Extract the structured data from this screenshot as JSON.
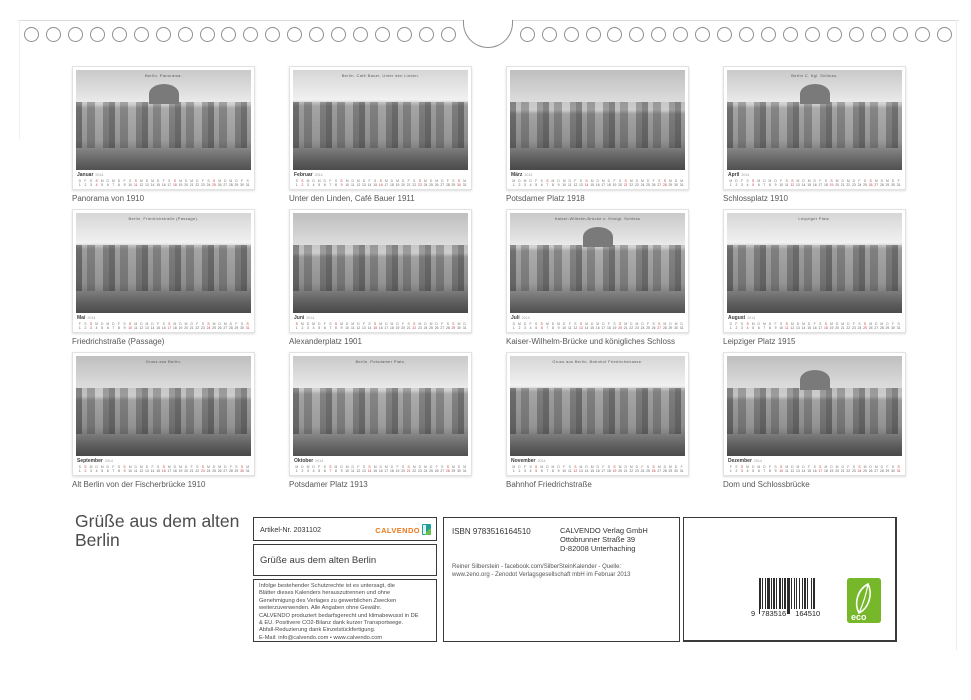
{
  "title": {
    "lines": "Grüße aus dem alten\nBerlin"
  },
  "months": [
    {
      "month": "Januar",
      "year": "2014",
      "caption": "Panorama von 1910",
      "photo_label": "Berlin.   Panorama."
    },
    {
      "month": "Februar",
      "year": "2014",
      "caption": "Unter den Linden, Café Bauer 1911",
      "photo_label": "Berlin.   Café Bauer, Unter den Linden."
    },
    {
      "month": "März",
      "year": "2014",
      "caption": "Potsdamer Platz 1918",
      "photo_label": ""
    },
    {
      "month": "April",
      "year": "2014",
      "caption": "Schlossplatz 1910",
      "photo_label": "Berlin C.   Kgl. Schloss."
    },
    {
      "month": "Mai",
      "year": "2014",
      "caption": "Friedrichstraße (Passage)",
      "photo_label": "Berlin.   Friedrichstraße (Passage)."
    },
    {
      "month": "Juni",
      "year": "2014",
      "caption": "Alexanderplatz 1901",
      "photo_label": ""
    },
    {
      "month": "Juli",
      "year": "2014",
      "caption": "Kaiser-Wilhelm-Brücke und königliches Schloss",
      "photo_label": "Kaiser-Wilhelm-Brücke u. Königl. Schloss"
    },
    {
      "month": "August",
      "year": "2014",
      "caption": "Leipziger Platz 1915",
      "photo_label": "Leipziger Platz."
    },
    {
      "month": "September",
      "year": "2014",
      "caption": "Alt Berlin von der Fischerbrücke 1910",
      "photo_label": "Gruss aus Berlin."
    },
    {
      "month": "Oktober",
      "year": "2014",
      "caption": "Potsdamer Platz 1913",
      "photo_label": "Berlin.   Potsdamer Platz."
    },
    {
      "month": "November",
      "year": "2014",
      "caption": "Bahnhof Friedrichstraße",
      "photo_label": "Gruss aus Berlin.   Bahnhof Friedrichstrasse."
    },
    {
      "month": "Dezember",
      "year": "2014",
      "caption": "Dom und Schlossbrücke",
      "photo_label": ""
    }
  ],
  "infobox": {
    "article_number": "Artikel-Nr. 2031102",
    "logo_word": "CALVENDO",
    "product_title": "Grüße aus dem alten Berlin",
    "legal_lines": "Infolge bestehender Schutzrechte ist es untersagt, die\nBlätter dieses Kalenders herauszutrennen und ohne\nGenehmigung des Verlages zu gewerblichen Zwecken\nweiterzuverwenden. Alle Angaben ohne Gewähr.\nCALVENDO produziert bedarfsgerecht und klimabewusst in DE\n& EU. Positivere CO2-Bilanz dank kurzer Transportwege.\nAbfall-Reduzierung dank Einzelstückfertigung.\nE-Mail: info@calvendo.com • www.calvendo.com"
  },
  "publisher": {
    "isbn": "ISBN 9783516164510",
    "address_lines": "CALVENDO Verlag GmbH\nOttobrunner Straße 39\nD-82008 Unterhaching",
    "credit_lines": "Reiner Silberstein - facebook.com/SilberSteinKalender - Quelle:\nwww.zeno.org - Zenodot Verlagsgesellschaft mbH im Februar 2013"
  },
  "barcode": {
    "digit_left": "9",
    "digit_mid": "783516",
    "digit_right": "164510"
  },
  "eco_label": "eco",
  "colors": {
    "logo_orange": "#e8791c",
    "logo_teal": "#1f9e9b",
    "eco_green": "#76b82a",
    "calendar_red": "#c43b3b",
    "box_border": "#3a3a3a"
  }
}
